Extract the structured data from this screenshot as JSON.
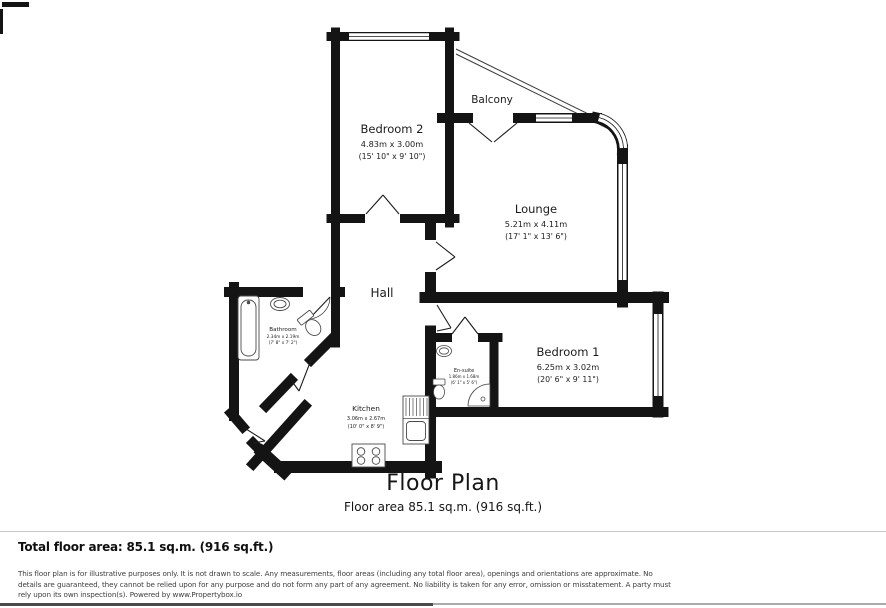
{
  "plan": {
    "title": "Floor Plan",
    "subtitle": "Floor area 85.1 sq.m. (916 sq.ft.)",
    "rooms": {
      "bedroom2": {
        "name": "Bedroom 2",
        "metric": "4.83m x 3.00m",
        "imperial": "(15' 10\" x 9' 10\")"
      },
      "balcony": {
        "name": "Balcony"
      },
      "lounge": {
        "name": "Lounge",
        "metric": "5.21m x 4.11m",
        "imperial": "(17' 1\" x 13' 6\")"
      },
      "hall": {
        "name": "Hall"
      },
      "bathroom": {
        "name": "Bathroom",
        "metric": "2.34m x 2.19m",
        "imperial": "(7' 8\" x 7' 2\")"
      },
      "kitchen": {
        "name": "Kitchen",
        "metric": "3.06m x 2.67m",
        "imperial": "(10' 0\" x 8' 9\")"
      },
      "ensuite": {
        "name": "En-suite",
        "metric": "1.86m x 1.68m",
        "imperial": "(6' 1\" x 5' 6\")"
      },
      "bedroom1": {
        "name": "Bedroom 1",
        "metric": "6.25m x 3.02m",
        "imperial": "(20' 6\" x 9' 11\")"
      }
    }
  },
  "footer": {
    "total_label": "Total floor area: 85.1 sq.m. (916 sq.ft.)",
    "disclaimer": "This floor plan is for illustrative purposes only. It is not drawn to scale. Any measurements, floor areas (including any total floor area), openings and orientations are approximate. No details are guaranteed, they cannot be relied upon for any purpose and do not form any part of any agreement. No liability is taken for any error, omission or misstatement. A party must rely upon its own inspection(s). Powered by www.Propertybox.io"
  },
  "colors": {
    "wall": "#141414",
    "divider": "#c9c9c9"
  }
}
